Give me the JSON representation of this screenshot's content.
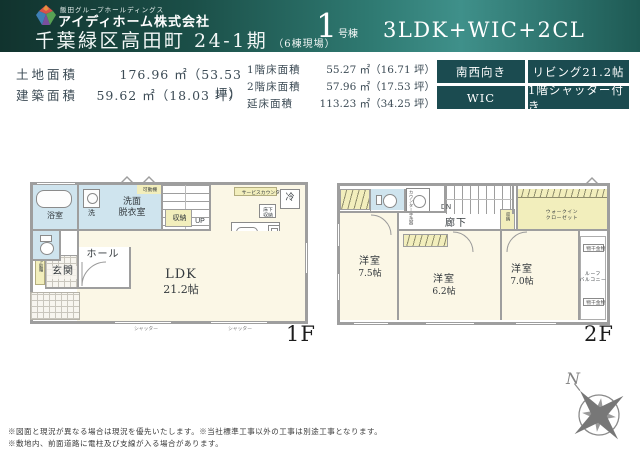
{
  "header": {
    "group_name": "飯田グループホールディングス",
    "company_name": "アイディホーム株式会社",
    "property_title": "千葉緑区高田町 24-1期",
    "property_note": "（6棟現場）",
    "unit_number": "1",
    "unit_suffix": "号棟",
    "plan_type": "3LDK+WIC+2CL"
  },
  "specs": {
    "site": {
      "label": "土地面積",
      "value": "176.96 ㎡（53.53 坪）"
    },
    "building": {
      "label": "建築面積",
      "value": "59.62 ㎡（18.03 坪）"
    },
    "floor1": {
      "label": "1階床面積",
      "value": "55.27 ㎡（16.71 坪）"
    },
    "floor2": {
      "label": "2階床面積",
      "value": "57.96 ㎡（17.53 坪）"
    },
    "total": {
      "label": "延床面積",
      "value": "113.23 ㎡（34.25 坪）"
    }
  },
  "badges": {
    "facing": "南西向き",
    "living": "リビング21.2帖",
    "wic": "WIC",
    "shutter": "1階シャッター付き"
  },
  "floor1": {
    "floor_label": "1F",
    "bath": "浴室",
    "washer": "洗",
    "washroom": "洗面\n脱衣室",
    "movable_shelf": "可動棚",
    "storage": "収納",
    "up": "UP",
    "toilet": "",
    "genkan": "玄関",
    "hall": "ホール",
    "shoe_box": "下駄箱",
    "ldk_name": "LDK",
    "ldk_size": "21.2帖",
    "fridge": "冷",
    "service_counter": "サービスカウンター",
    "underfloor": "床下\n収納",
    "shutter1": "シャッター",
    "shutter2": "シャッター"
  },
  "floor2": {
    "floor_label": "2F",
    "counter_sink": "カウンター手洗器",
    "dn": "DN",
    "hallway": "廊下",
    "storage": "収納",
    "wic": "ウォークイン\nクローゼット",
    "monohoshi_top": "物干金物",
    "monohoshi_bottom": "物干金物",
    "roof_balcony": "ルーフ\nバルコニー",
    "room1_name": "洋室",
    "room1_size": "7.5帖",
    "room2_name": "洋室",
    "room2_size": "6.2帖",
    "room3_name": "洋室",
    "room3_size": "7.0帖"
  },
  "footer": {
    "note1": "※図面と現況が異なる場合は現況を優先いたします。※当社標準工事以外の工事は別途工事となります。",
    "note2": "※敷地内、前面道路に電柱及び支線が入る場合があります。",
    "compass": "N"
  },
  "colors": {
    "header_teal": "#2f7a72",
    "badge_teal": "#1b4b50",
    "room_cream": "#fbf7e6",
    "room_blue": "#cfe4ee",
    "closet_yellow": "#f2eebc",
    "wall_gray": "#9e9e9e"
  }
}
